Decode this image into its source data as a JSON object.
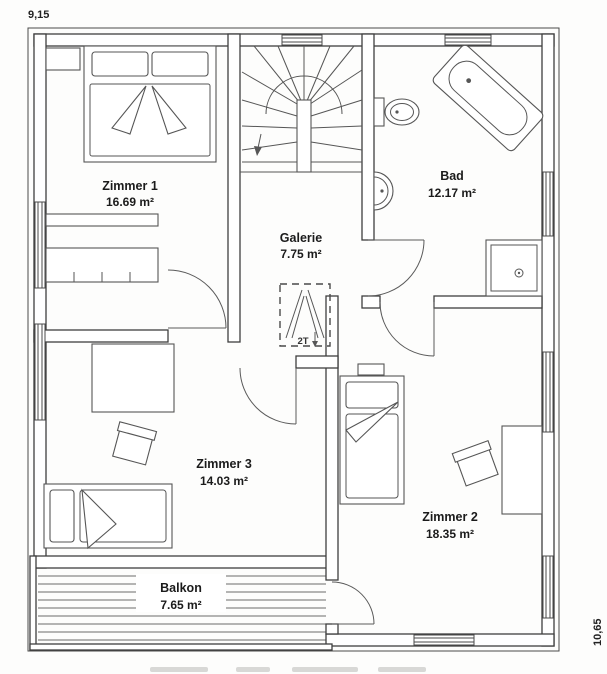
{
  "plan": {
    "title": "Obergeschoss Grundriss",
    "dimension_width_label": "9,15",
    "dimension_height_label": "10,65"
  },
  "rooms": [
    {
      "name": "Zimmer 1",
      "area": "16.69 m²"
    },
    {
      "name": "Galerie",
      "area": "7.75 m²"
    },
    {
      "name": "Bad",
      "area": "12.17 m²"
    },
    {
      "name": "Zimmer 3",
      "area": "14.03 m²"
    },
    {
      "name": "Zimmer 2",
      "area": "18.35 m²"
    },
    {
      "name": "Balkon",
      "area": "7.65 m²"
    }
  ],
  "annotations": {
    "loft_hatch_label": "2T"
  },
  "colors": {
    "line": "#4a4a4a",
    "wall_outline": "#3f3f3f",
    "text": "#1b1b1b",
    "background": "#ffffff"
  }
}
